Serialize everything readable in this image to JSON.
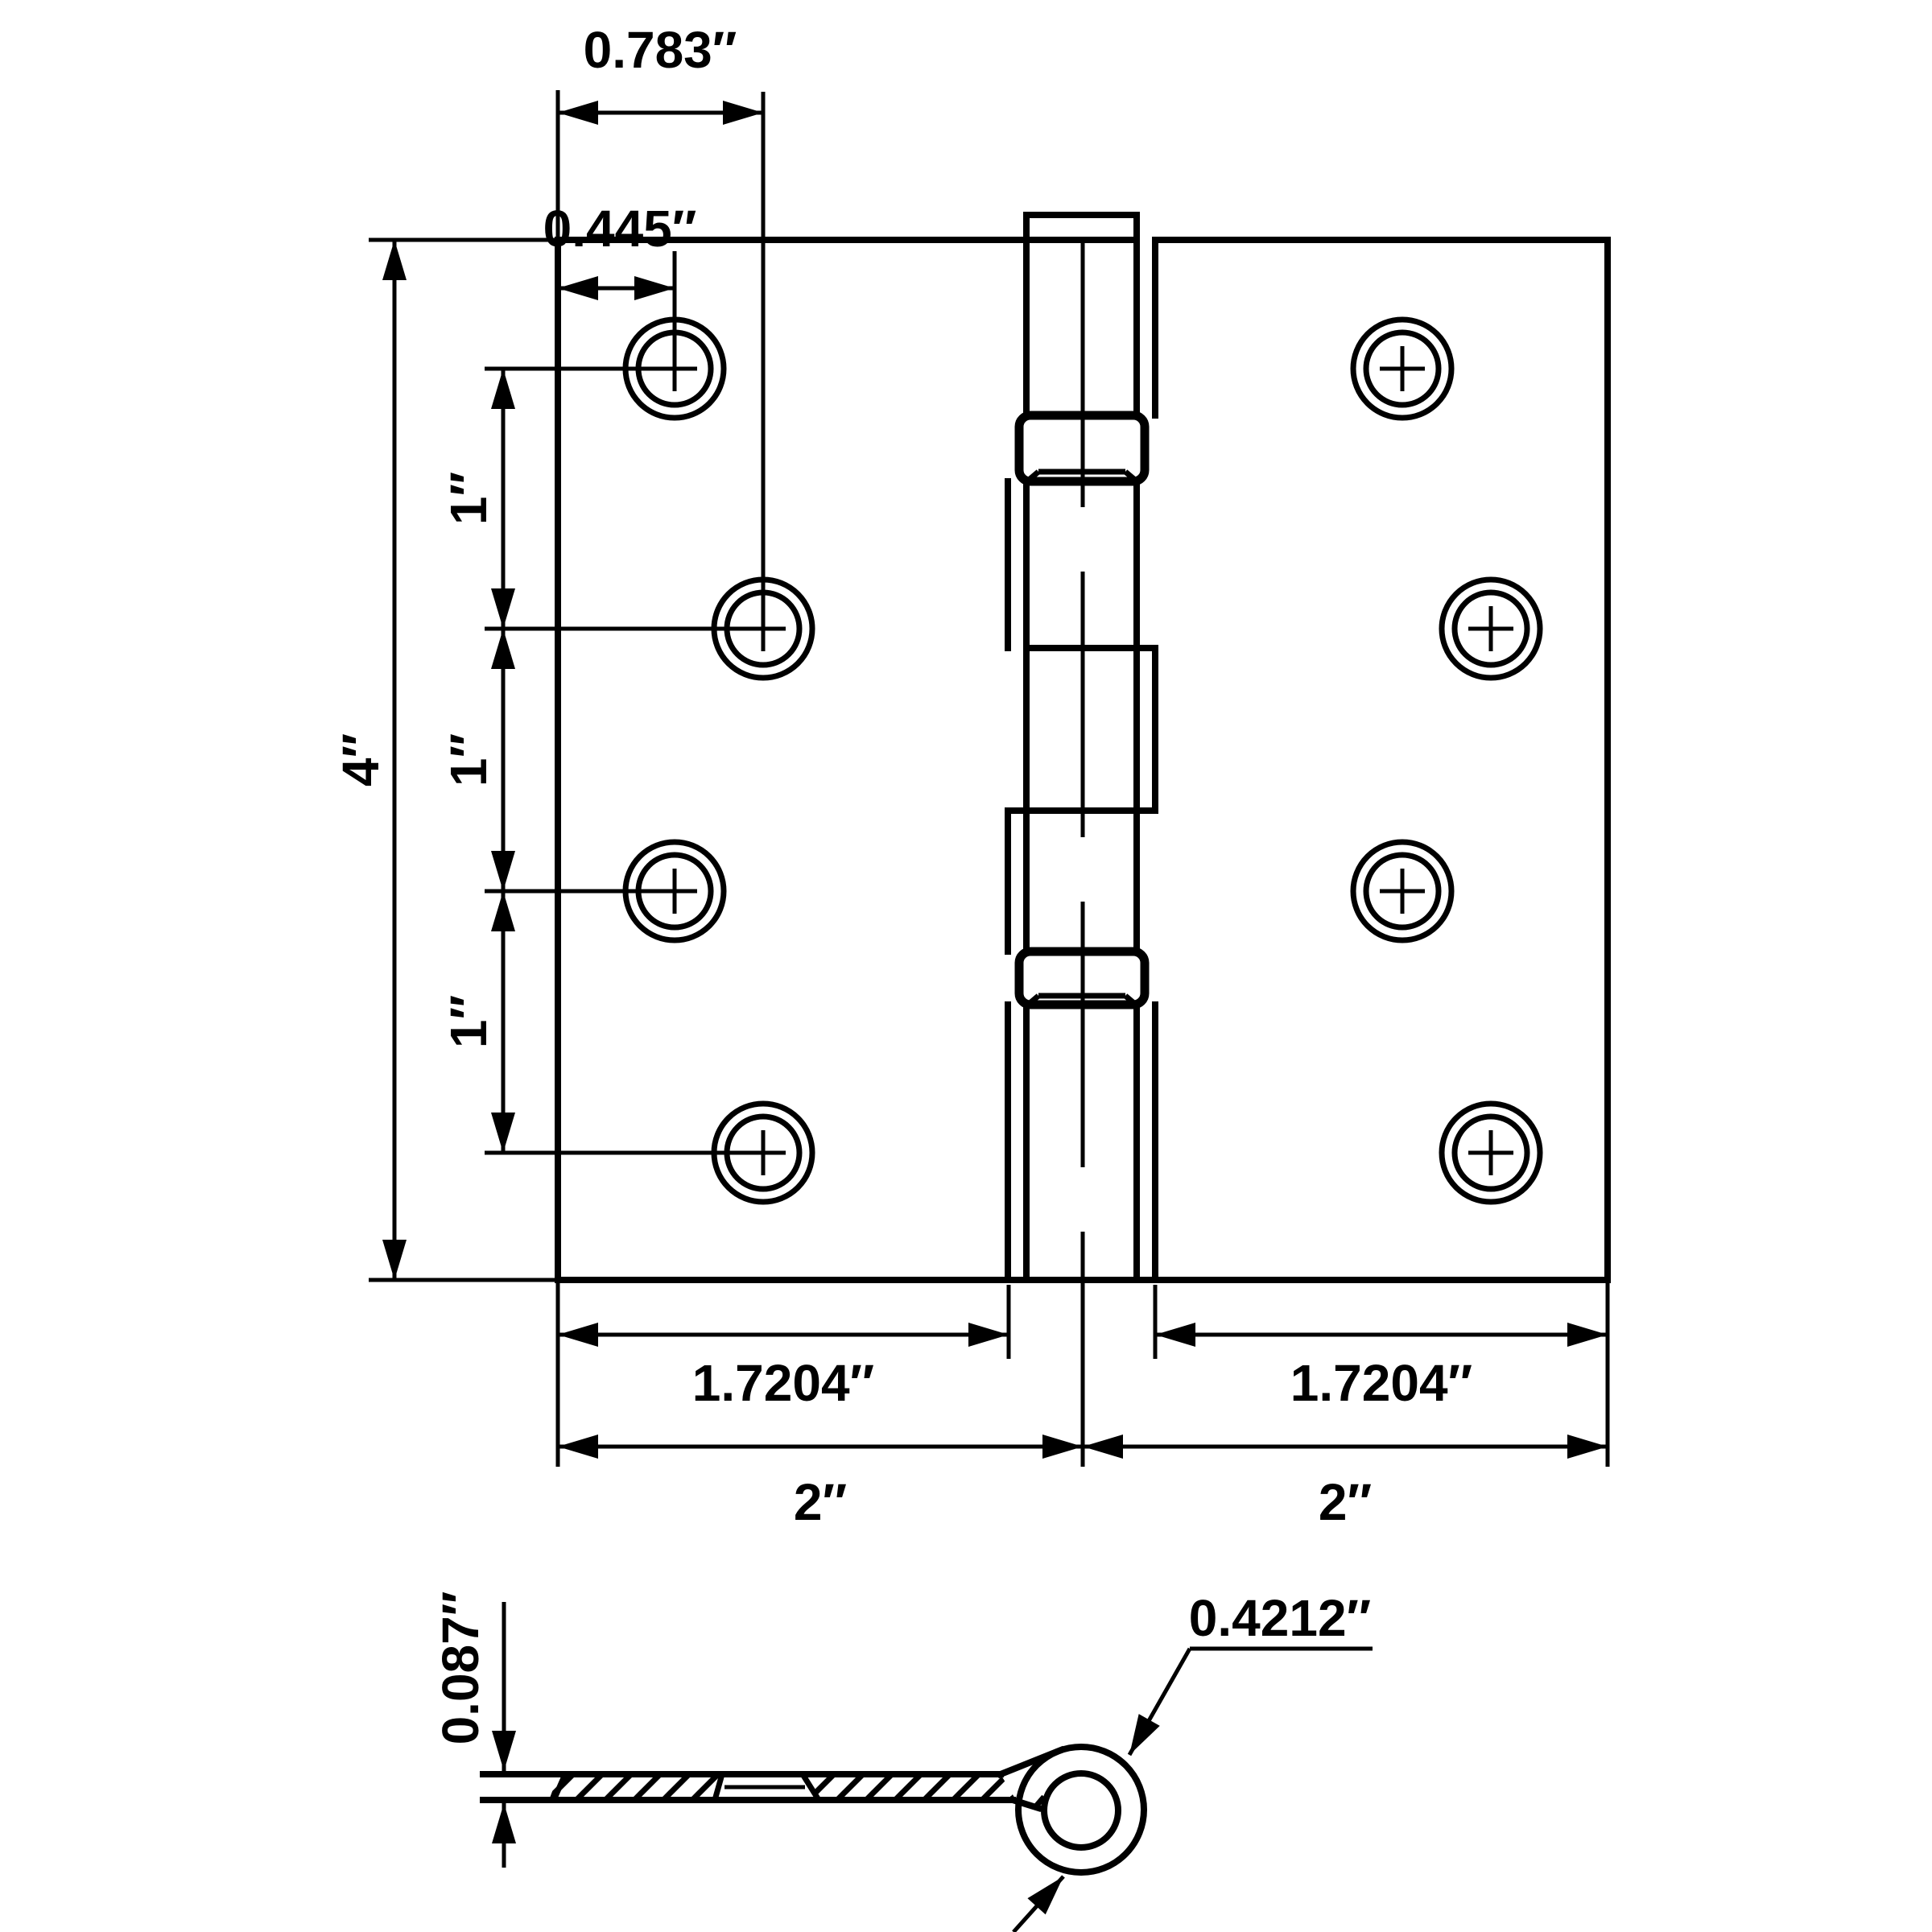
{
  "drawing": {
    "type": "hinge-dimension-diagram",
    "units": "inches",
    "front": {
      "dim_top_outer": "0.783″",
      "dim_top_inner": "0.445″",
      "dim_height": "4″",
      "spacings": [
        "1″",
        "1″",
        "1″"
      ],
      "dim_leaf_left": "1.7204″",
      "dim_leaf_right": "1.7204″",
      "dim_half_left": "2″",
      "dim_half_right": "2″",
      "screw_hole_count": 8
    },
    "side": {
      "dim_thickness": "0.087″",
      "dim_knuckle_diameter": "0.4212″"
    },
    "colors": {
      "line": "#000000",
      "background": "#ffffff"
    }
  }
}
